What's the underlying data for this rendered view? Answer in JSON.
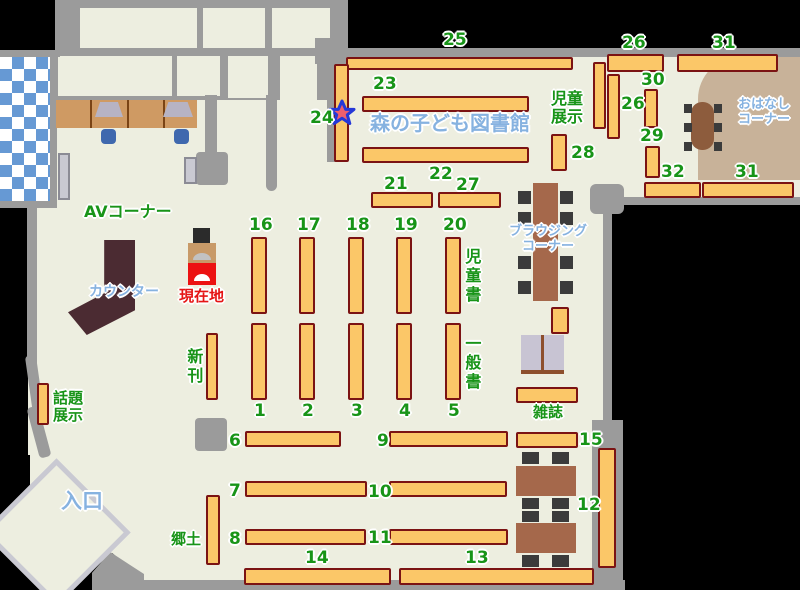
{
  "title": "森の子ども図書館",
  "areas": {
    "av": "AVコーナー",
    "counter": "カウンター",
    "current_location": "現在地",
    "new_books": "新刊",
    "topic_display_line1": "話題",
    "topic_display_line2": "展示",
    "entrance": "入口",
    "local_history": "郷土",
    "children_books": "児童書",
    "general_books": "一般書",
    "magazines": "雑誌",
    "children_display_line1": "児童",
    "children_display_line2": "展示",
    "browsing_line1": "ブラウジング",
    "browsing_line2": "コーナー",
    "story_line1": "おはなし",
    "story_line2": "コーナー"
  },
  "shelf_numbers": {
    "n1": "1",
    "n2": "2",
    "n3": "3",
    "n4": "4",
    "n5": "5",
    "n6": "6",
    "n7": "7",
    "n8": "8",
    "n9": "9",
    "n10": "10",
    "n11": "11",
    "n12": "12",
    "n13": "13",
    "n14": "14",
    "n15": "15",
    "n16": "16",
    "n17": "17",
    "n18": "18",
    "n19": "19",
    "n20": "20",
    "n21": "21",
    "n22": "22",
    "n23": "23",
    "n24": "24",
    "n25": "25",
    "n26": "26",
    "n27": "27",
    "n28": "28",
    "n29": "29",
    "n30": "30",
    "n31": "31",
    "n32": "32"
  },
  "icons": {
    "current_location_star": "star-marker"
  },
  "colors": {
    "shelf_fill": "#fbc768",
    "shelf_border": "#7b1313",
    "label_green": "#189418",
    "label_blue": "#86b2e0",
    "label_red": "#e51515",
    "floor": "#edeee0",
    "wall": "#9b9b9b",
    "story_corner_bg": "#c8b299",
    "counter": "#4b2b32",
    "table_brown": "#a5684b",
    "checker_blue": "#6699d4"
  }
}
